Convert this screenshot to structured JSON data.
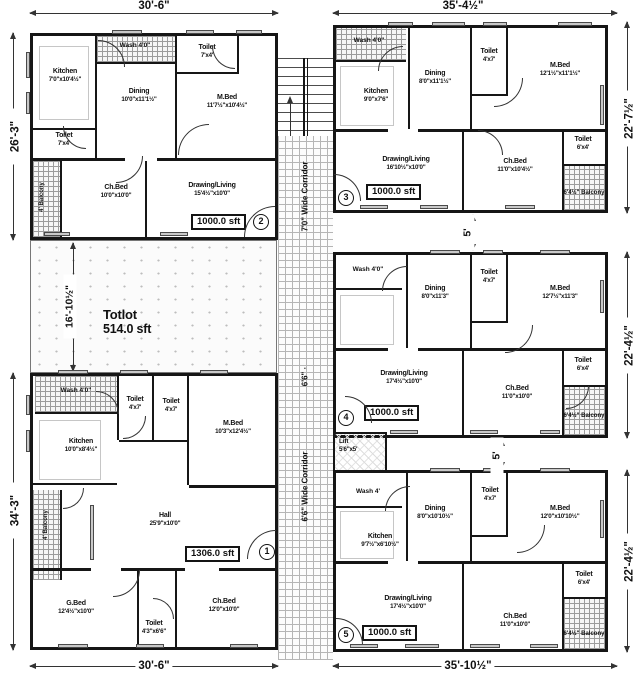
{
  "drawing": {
    "corridor_upper": "7'0\" Wide Corridor",
    "corridor_mid": "6'6\" ·",
    "corridor_lower": "6'6\" Wide Corridor",
    "stairs_up": "up",
    "totlot_name": "Totlot",
    "totlot_area": "514.0 sft",
    "lift_name": "Lift",
    "lift_size": "5'6\"x5'"
  },
  "dims": {
    "top_left": "30'-6\"",
    "top_right": "35'-4½\"",
    "left_top": "26'-3\"",
    "left_bottom": "34'-3\"",
    "right_top": "22'-7½\"",
    "right_mid": "22'-4½\"",
    "right_bottom": "22'-4½\"",
    "bottom_left": "30'-6\"",
    "bottom_right": "35'-10½\"",
    "totlot_width": "16'-10½\"",
    "gap_34": "5'",
    "gap_45": "5'"
  },
  "units": {
    "u1": {
      "number": "1",
      "area": "1306.0 sft",
      "rooms": {
        "wash": {
          "name": "Wash 4'0\""
        },
        "toilet_a": {
          "name": "Toilet",
          "size": "4'x7'"
        },
        "toilet_b": {
          "name": "Toilet",
          "size": "4'x7'"
        },
        "mbed": {
          "name": "M.Bed",
          "size": "10'3\"x12'4½\""
        },
        "kitchen": {
          "name": "Kitchen",
          "size": "10'0\"x8'4½\""
        },
        "balcony": {
          "name": "4' Balcony"
        },
        "hall": {
          "name": "Hall",
          "size": "25'9\"x10'0\""
        },
        "gbed": {
          "name": "G.Bed",
          "size": "12'4½\"x10'0\""
        },
        "toilet_c": {
          "name": "Toilet",
          "size": "4'3\"x6'6\""
        },
        "chbed": {
          "name": "Ch.Bed",
          "size": "12'0\"x10'0\""
        }
      }
    },
    "u2": {
      "number": "2",
      "area": "1000.0 sft",
      "rooms": {
        "kitchen": {
          "name": "Kitchen",
          "size": "7'0\"x10'4½\""
        },
        "wash": {
          "name": "Wash 4'0\""
        },
        "toilet_top": {
          "name": "Toilet",
          "size": "7'x4'"
        },
        "dining": {
          "name": "Dining",
          "size": "10'0\"x11'1½\""
        },
        "mbed": {
          "name": "M.Bed",
          "size": "11'7½\"x10'4½\""
        },
        "toilet_left": {
          "name": "Toilet",
          "size": "7'x4'"
        },
        "balcony": {
          "name": "4' Balcony"
        },
        "chbed": {
          "name": "Ch.Bed",
          "size": "10'0\"x10'0\""
        },
        "living": {
          "name": "Drawing/Living",
          "size": "15'4½\"x10'0\""
        }
      }
    },
    "u3": {
      "number": "3",
      "area": "1000.0 sft",
      "rooms": {
        "wash": {
          "name": "Wash 4'0\""
        },
        "kitchen": {
          "name": "Kitchen",
          "size": "9'0\"x7'6\""
        },
        "dining": {
          "name": "Dining",
          "size": "8'0\"x11'1½\""
        },
        "toilet": {
          "name": "Toilet",
          "size": "4'x7'"
        },
        "mbed": {
          "name": "M.Bed",
          "size": "12'1½\"x11'1½\""
        },
        "toilet2": {
          "name": "Toilet",
          "size": "6'x4'"
        },
        "living": {
          "name": "Drawing/Living",
          "size": "16'10½\"x10'0\""
        },
        "chbed": {
          "name": "Ch.Bed",
          "size": "11'0\"x10'4½\""
        },
        "balcony": {
          "name": "6'4½\" Balcony"
        }
      }
    },
    "u4": {
      "number": "4",
      "area": "1000.0 sft",
      "rooms": {
        "wash": {
          "name": "Wash 4'0\""
        },
        "dining": {
          "name": "Dining",
          "size": "8'0\"x11'3\""
        },
        "toilet": {
          "name": "Toilet",
          "size": "4'x7'"
        },
        "mbed": {
          "name": "M.Bed",
          "size": "12'7½\"x11'3\""
        },
        "toilet2": {
          "name": "Toilet",
          "size": "6'x4'"
        },
        "living": {
          "name": "Drawing/Living",
          "size": "17'4½\"x10'0\""
        },
        "chbed": {
          "name": "Ch.Bed",
          "size": "11'0\"x10'0\""
        },
        "balcony": {
          "name": "6'4½\" Balcony"
        }
      }
    },
    "u5": {
      "number": "5",
      "area": "1000.0 sft",
      "rooms": {
        "wash": {
          "name": "Wash 4'"
        },
        "dining": {
          "name": "Dining",
          "size": "8'0\"x10'10½\""
        },
        "toilet": {
          "name": "Toilet",
          "size": "4'x7'"
        },
        "mbed": {
          "name": "M.Bed",
          "size": "12'0\"x10'10½\""
        },
        "kitchen": {
          "name": "Kitchen",
          "size": "9'7½\"x6'10½\""
        },
        "toilet2": {
          "name": "Toilet",
          "size": "6'x4'"
        },
        "living": {
          "name": "Drawing/Living",
          "size": "17'4½\"x10'0\""
        },
        "chbed": {
          "name": "Ch.Bed",
          "size": "11'0\"x10'0\""
        },
        "balcony": {
          "name": "6'4½\" Balcony"
        }
      }
    }
  }
}
